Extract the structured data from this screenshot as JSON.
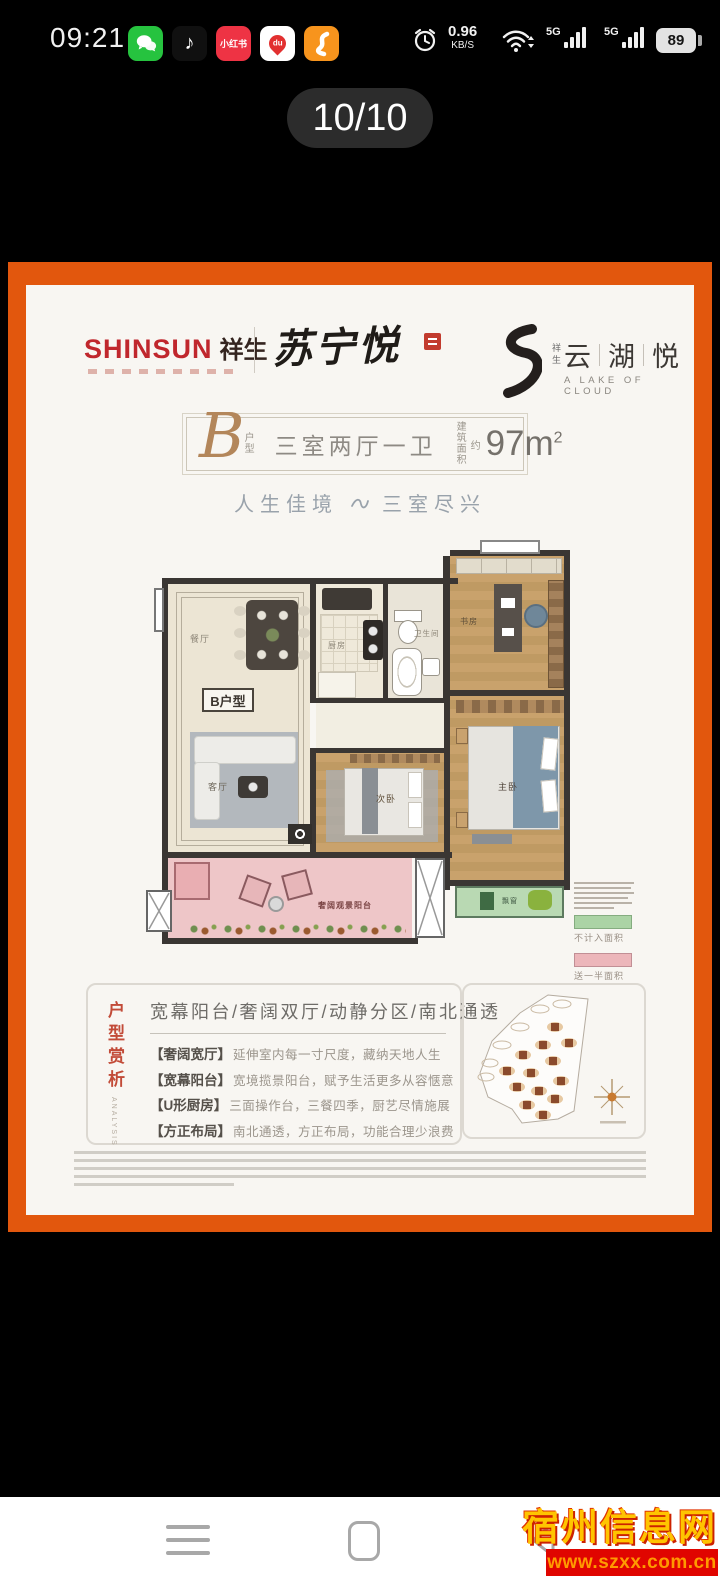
{
  "status_bar": {
    "time": "09:21",
    "apps": {
      "douyin_glyph": "♪",
      "xiaohongshu_label": "小红书",
      "baidu_pin_label": "du"
    },
    "network": {
      "speed": "0.96",
      "speed_unit": "KB/S",
      "badge1": "5G",
      "badge2": "5G"
    },
    "battery": "89"
  },
  "pager": {
    "label": "10/10"
  },
  "flyer": {
    "header": {
      "brand": "SHINSUN",
      "brand_cn": "祥生",
      "calligraphy": "苏宁悦",
      "right_vertical": "祥生",
      "right_name_1": "云",
      "right_name_2": "湖",
      "right_name_3": "悦",
      "right_subtitle": "A LAKE OF CLOUD"
    },
    "titlebox": {
      "letter": "B",
      "unit_1": "户",
      "unit_2": "型",
      "layout": "三室两厅一卫",
      "area_label_1": "建筑",
      "area_label_2": "面积",
      "area_approx": "约",
      "area_value": "97m",
      "area_sup": "2"
    },
    "tagline": {
      "left": "人生佳境",
      "right": "三室尽兴"
    },
    "floorplan": {
      "unit_label": "B户型",
      "rooms": {
        "dining": "餐厅",
        "kitchen": "厨房",
        "bath": "卫生间",
        "study": "书房",
        "living": "客厅",
        "bedroom2": "次卧",
        "master": "主卧",
        "bay": "飘窗"
      },
      "balcony_label": "奢阔观景阳台",
      "legend": {
        "green_label": "不计入面积",
        "green_color": "#abd3a5",
        "pink_label": "送一半面积",
        "pink_color": "#ecb6ba"
      }
    },
    "analysis": {
      "vertical_title": "户型赏析",
      "vertical_subtitle": "ANALYSIS",
      "headline": "宽幕阳台/奢阔双厅/动静分区/南北通透",
      "bullets": [
        {
          "tag": "【奢阔宽厅】",
          "desc": "延伸室内每一寸尺度，藏纳天地人生"
        },
        {
          "tag": "【宽幕阳台】",
          "desc": "宽境揽景阳台，赋予生活更多从容惬意"
        },
        {
          "tag": "【U形厨房】",
          "desc": "三面操作台，三餐四季，厨艺尽情施展"
        },
        {
          "tag": "【方正布局】",
          "desc": "南北通透，方正布局，功能合理少浪费"
        }
      ]
    },
    "colors": {
      "accent_orange": "#e2570d",
      "brand_red": "#c0272d",
      "gold": "#b3865a"
    }
  },
  "watermark": {
    "site_name": "宿州信息网",
    "site_url": "www.szxx.com.cn"
  }
}
